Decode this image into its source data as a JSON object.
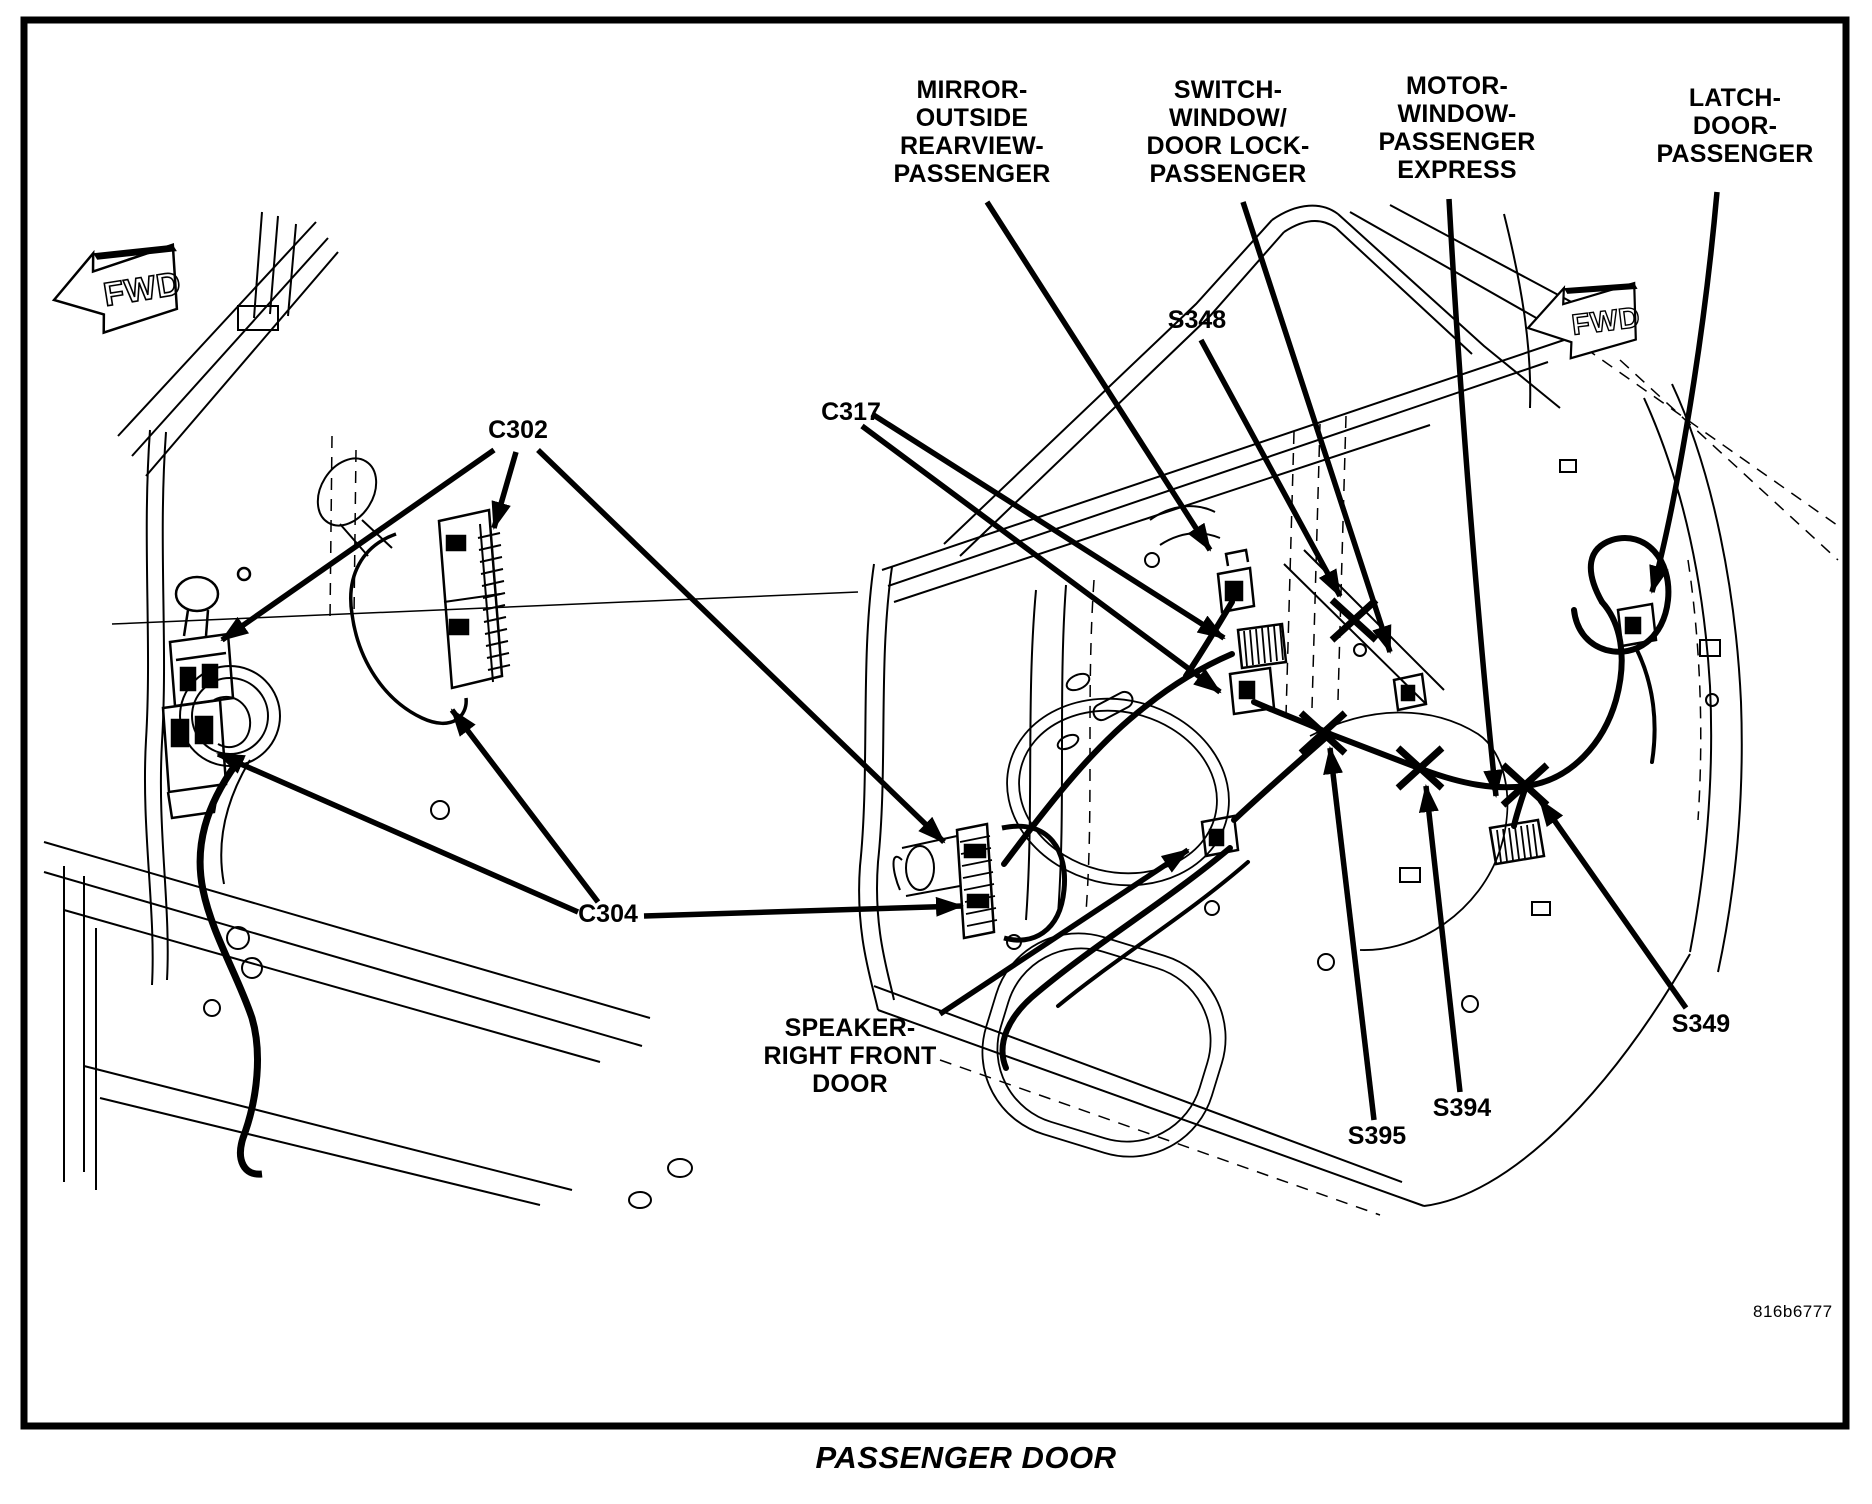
{
  "figure_id": "816b6777",
  "title": "PASSENGER DOOR",
  "fwd": "FWD",
  "callouts": {
    "mirror": {
      "lines": [
        "MIRROR-",
        "OUTSIDE",
        "REARVIEW-",
        "PASSENGER"
      ]
    },
    "switch": {
      "lines": [
        "SWITCH-",
        "WINDOW/",
        "DOOR LOCK-",
        "PASSENGER"
      ]
    },
    "motor": {
      "lines": [
        "MOTOR-",
        "WINDOW-",
        "PASSENGER",
        "EXPRESS"
      ]
    },
    "latch": {
      "lines": [
        "LATCH-",
        "DOOR-",
        "PASSENGER"
      ]
    },
    "speaker": {
      "lines": [
        "SPEAKER-",
        "RIGHT FRONT",
        "DOOR"
      ]
    }
  },
  "connectors": {
    "c302": "C302",
    "c317": "C317",
    "c304": "C304"
  },
  "splices": {
    "s348": "S348",
    "s349": "S349",
    "s394": "S394",
    "s395": "S395"
  },
  "colors": {
    "ink": "#000000",
    "paper": "#ffffff"
  }
}
